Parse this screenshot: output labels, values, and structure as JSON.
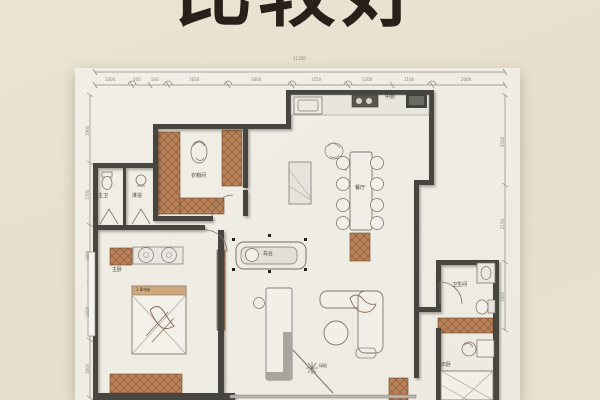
{
  "title": {
    "text": "比较好"
  },
  "plan": {
    "rooms": [
      {
        "label": "主卧"
      },
      {
        "label": "衣帽间"
      },
      {
        "label": "主卫"
      },
      {
        "label": "淋浴"
      },
      {
        "label": "中厨"
      },
      {
        "label": "餐厅"
      },
      {
        "label": "岛台"
      },
      {
        "label": "卫生间"
      },
      {
        "label": "次卧"
      }
    ],
    "furniture": {
      "bed_main": "1.8m床",
      "plant": "绿植"
    },
    "dims": {
      "top_total": "11350",
      "top": [
        "1000",
        "500",
        "500",
        "1650",
        "1800",
        "1550",
        "1200",
        "1100",
        "2000"
      ],
      "left": [
        "1900",
        "1700",
        "1600",
        "1550",
        "1600"
      ],
      "right": [
        "2500",
        "2150",
        "1900"
      ]
    },
    "colors": {
      "wall": "#474440",
      "wood": "#b9825a",
      "paper": "#f0ede5",
      "background": "#e9e1cf"
    }
  }
}
